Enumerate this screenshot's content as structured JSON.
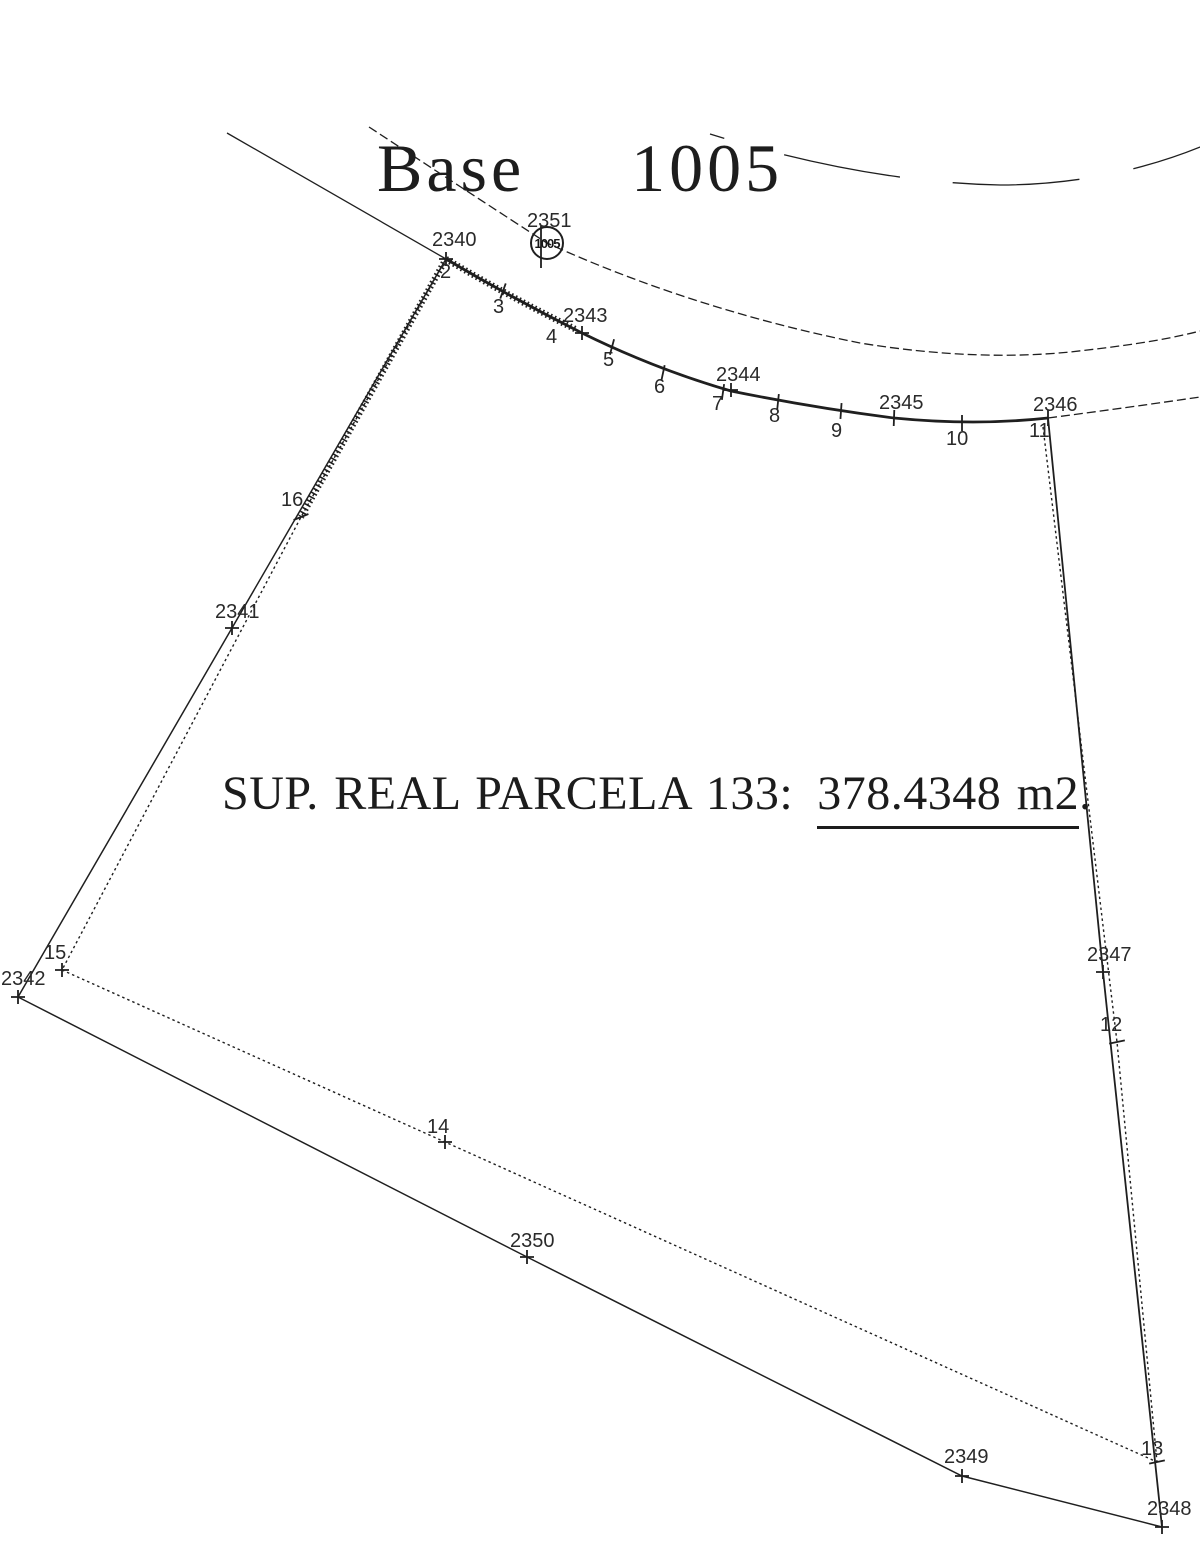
{
  "drawing": {
    "title": "Base 1005",
    "area_text": {
      "prefix": "SUP. REAL PARCELA 133:",
      "value": "378.4348 m2",
      "suffix": "."
    },
    "colors": {
      "ink": "#1f1f1f",
      "background": "#ffffff"
    },
    "station": {
      "label": "2351",
      "x": 547,
      "y": 243,
      "r": 16,
      "symbol_text": "1005",
      "label_x": 527,
      "label_y": 227
    },
    "geometry": {
      "paths": [
        {
          "name": "leadin-top-left",
          "style": "thin",
          "d": "M 227 133 L 446 259"
        },
        {
          "name": "top-boundary-curve",
          "style": "thick",
          "d": "M 446 259 Q 512 298 582 333 Q 655 369 731 391 Q 815 408 894 418 Q 975 426 1048 418"
        },
        {
          "name": "top-boundary-hatch",
          "style": "hatch",
          "d": "M 446 259 Q 512 298 575 329"
        },
        {
          "name": "road-continuation-right",
          "style": "thin-dash",
          "d": "M 1048 418 Q 1125 408 1200 397"
        },
        {
          "name": "road-edge-inner",
          "style": "thin-dash",
          "d": "M 369 127 C 450 180 505 216 547 243 C 650 290 760 323 860 343 C 940 356 1010 358 1070 352 C 1115 347 1162 341 1200 331"
        },
        {
          "name": "road-edge-outer",
          "style": "long-dash",
          "d": "M 710 134 C 800 162 900 183 1000 185 C 1080 185 1150 168 1205 145"
        },
        {
          "name": "left-boundary-solid",
          "style": "solid",
          "d": "M 446 259 L 232 628 L 18 997"
        },
        {
          "name": "left-boundary-dotted",
          "style": "dotted",
          "d": "M 446 259 L 301 517 L 62 970"
        },
        {
          "name": "left-boundary-hatch",
          "style": "hatch",
          "d": "M 446 259 L 301 517"
        },
        {
          "name": "bottom-boundary-dotted",
          "style": "dotted",
          "d": "M 62 970 L 445 1142 L 1157 1462"
        },
        {
          "name": "bottom-boundary-solid",
          "style": "solid",
          "d": "M 18 997 L 527 1257 L 962 1476 L 1162 1527"
        },
        {
          "name": "right-boundary-solid",
          "style": "solid-heavy",
          "d": "M 1048 418 L 1103 972 L 1162 1527"
        },
        {
          "name": "right-boundary-dotted",
          "style": "dotted",
          "d": "M 1043 427 L 1117 1042 L 1157 1462"
        }
      ],
      "points": [
        {
          "id": "2340",
          "x": 446,
          "y": 259,
          "marker": "cross",
          "lx": 432,
          "ly": 246
        },
        {
          "id": "2",
          "x": 446,
          "y": 259,
          "marker": "none",
          "lx": 440,
          "ly": 278
        },
        {
          "id": "3",
          "x": 503,
          "y": 291,
          "marker": "tick",
          "angle": 20,
          "lx": 493,
          "ly": 313
        },
        {
          "id": "2343",
          "x": 582,
          "y": 333,
          "marker": "cross",
          "lx": 563,
          "ly": 322
        },
        {
          "id": "4",
          "x": 582,
          "y": 333,
          "marker": "none",
          "lx": 546,
          "ly": 343
        },
        {
          "id": "5",
          "x": 612,
          "y": 347,
          "marker": "tick",
          "angle": 15,
          "lx": 603,
          "ly": 366
        },
        {
          "id": "6",
          "x": 663,
          "y": 373,
          "marker": "tick",
          "angle": 12,
          "lx": 654,
          "ly": 393
        },
        {
          "id": "7",
          "x": 723,
          "y": 392,
          "marker": "tick",
          "angle": 8,
          "lx": 712,
          "ly": 410
        },
        {
          "id": "2344",
          "x": 731,
          "y": 390,
          "marker": "cross",
          "lx": 716,
          "ly": 381
        },
        {
          "id": "8",
          "x": 778,
          "y": 402,
          "marker": "tick",
          "angle": 6,
          "lx": 769,
          "ly": 422
        },
        {
          "id": "9",
          "x": 841,
          "y": 411,
          "marker": "tick",
          "angle": 4,
          "lx": 831,
          "ly": 437
        },
        {
          "id": "2345",
          "x": 894,
          "y": 418,
          "marker": "tick",
          "angle": 2,
          "lx": 879,
          "ly": 409
        },
        {
          "id": "10",
          "x": 962,
          "y": 423,
          "marker": "tick",
          "angle": 0,
          "lx": 946,
          "ly": 445
        },
        {
          "id": "2346",
          "x": 1048,
          "y": 418,
          "marker": "tick",
          "angle": 0,
          "lx": 1033,
          "ly": 411
        },
        {
          "id": "11",
          "x": 1043,
          "y": 427,
          "marker": "none",
          "lx": 1029,
          "ly": 437
        },
        {
          "id": "16",
          "x": 301,
          "y": 517,
          "marker": "tick",
          "angle": 68,
          "lx": 281,
          "ly": 506
        },
        {
          "id": "2341",
          "x": 232,
          "y": 628,
          "marker": "cross",
          "lx": 215,
          "ly": 618
        },
        {
          "id": "15",
          "x": 62,
          "y": 970,
          "marker": "cross",
          "lx": 44,
          "ly": 959
        },
        {
          "id": "2342",
          "x": 18,
          "y": 997,
          "marker": "cross",
          "lx": 1,
          "ly": 985
        },
        {
          "id": "2347",
          "x": 1103,
          "y": 972,
          "marker": "cross",
          "lx": 1087,
          "ly": 961
        },
        {
          "id": "12",
          "x": 1117,
          "y": 1042,
          "marker": "tick",
          "angle": 78,
          "lx": 1100,
          "ly": 1031
        },
        {
          "id": "14",
          "x": 445,
          "y": 1142,
          "marker": "cross",
          "lx": 427,
          "ly": 1133
        },
        {
          "id": "2350",
          "x": 527,
          "y": 1257,
          "marker": "cross",
          "lx": 510,
          "ly": 1247
        },
        {
          "id": "2349",
          "x": 962,
          "y": 1476,
          "marker": "cross",
          "lx": 944,
          "ly": 1463
        },
        {
          "id": "13",
          "x": 1157,
          "y": 1462,
          "marker": "tick",
          "angle": 78,
          "lx": 1141,
          "ly": 1455
        },
        {
          "id": "2348",
          "x": 1162,
          "y": 1527,
          "marker": "cross",
          "lx": 1147,
          "ly": 1515
        }
      ]
    }
  }
}
